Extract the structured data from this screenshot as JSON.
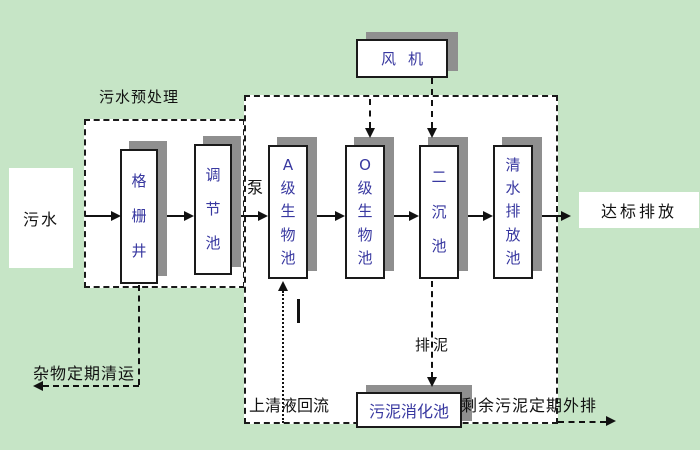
{
  "colors": {
    "background": "#c6e5c6",
    "region_fill": "#ffffff",
    "line": "#111111",
    "box_shadow": "#8f8f8f",
    "tank_text": "#3838a0",
    "label_text": "#111111"
  },
  "diagram": {
    "influent": "污水",
    "pretreatment_title": "污水预处理",
    "pump": "泵",
    "fan": "风机",
    "tanks": {
      "grid_well": "格栅井",
      "regulating": "调节池",
      "a_bio": "A级生物池",
      "o_bio": "O级生物池",
      "secondary_sedimentation": "二沉池",
      "clear_water_discharge": "清水排放池",
      "sludge_digestion": "污泥消化池"
    },
    "labels": {
      "discharge": "达标排放",
      "sludge_discharge": "排泥",
      "supernatant_return": "上清液回流",
      "excess_sludge_out": "剩余污泥定期外排",
      "debris_removal": "杂物定期清运"
    }
  }
}
